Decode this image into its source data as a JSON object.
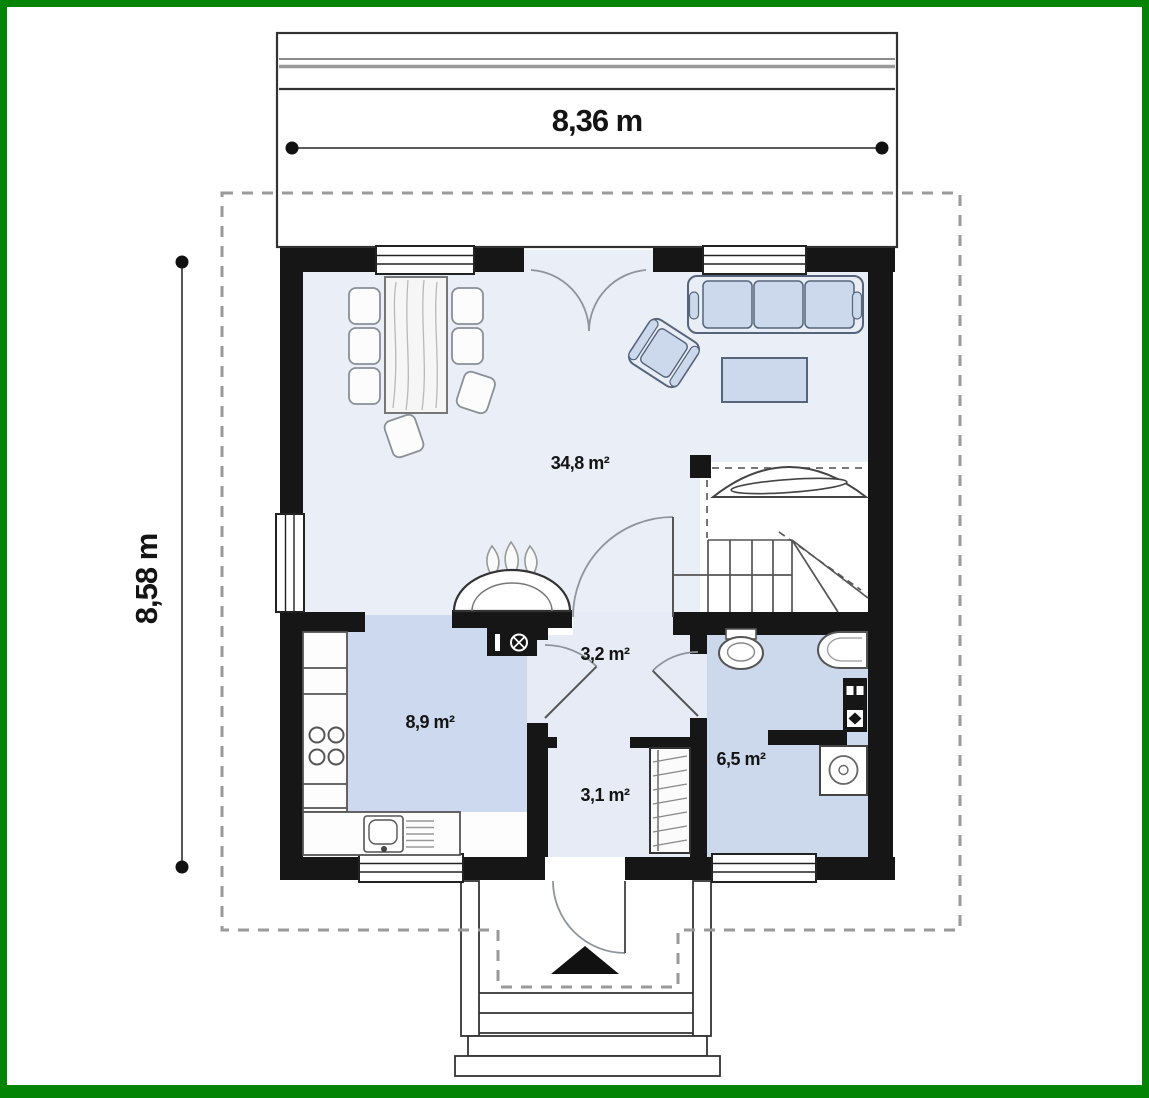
{
  "plan": {
    "type": "floor-plan",
    "floor": "ground floor"
  },
  "dimensions": {
    "width": {
      "label": "8,36 m"
    },
    "height": {
      "label": "8,58 m"
    }
  },
  "rooms": {
    "living_dining": {
      "area_label": "34,8 m²"
    },
    "hall_upper": {
      "area_label": "3,2 m²"
    },
    "kitchen": {
      "area_label": "8,9 m²"
    },
    "hall_lower": {
      "area_label": "3,1 m²"
    },
    "bathroom": {
      "area_label": "6,5 m²"
    }
  },
  "colors": {
    "frame_green": "#048404",
    "wall_black": "#161616",
    "floor_living": "#eaeef7",
    "floor_kitchen": "#cdd9ee",
    "floor_bathroom": "#ccd9ec",
    "floor_hall": "#e7ebf5",
    "furniture_blue": "#ccd9ec",
    "furniture_light": "#e9eef6",
    "dashed_boundary": "#9a9a9a",
    "paper_white": "#ffffff"
  },
  "icons": {
    "entrance_arrow": "filled-triangle-up",
    "fireplace_flames": "three-flames",
    "stove_symbol": "circle-cross"
  }
}
